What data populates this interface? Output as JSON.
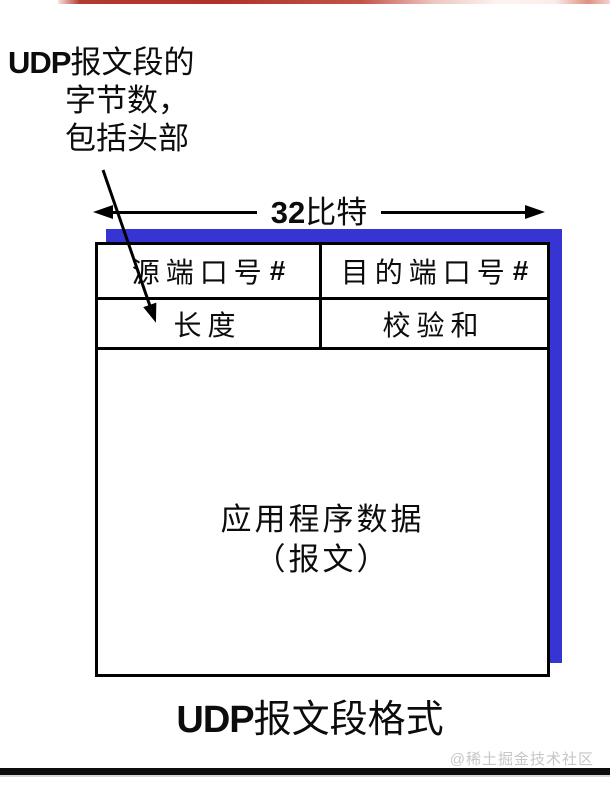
{
  "annotation": {
    "line1_latin": "UDP",
    "line1_cjk": "报文段的",
    "line2": "字节数，",
    "line3": "包括头部"
  },
  "width_label": {
    "number": "32",
    "unit": "比特"
  },
  "table": {
    "row1": {
      "cell1": {
        "label": "源端口号",
        "suffix": "#"
      },
      "cell2": {
        "label": "目的端口号",
        "suffix": "#"
      }
    },
    "row2": {
      "cell1": {
        "label": "长度",
        "suffix": ""
      },
      "cell2": {
        "label": "校验和",
        "suffix": ""
      }
    },
    "payload": {
      "line1": "应用程序数据",
      "line2": "（报文）"
    }
  },
  "caption": {
    "latin": "UDP",
    "cjk": "报文段格式"
  },
  "watermark": "@稀土掘金技术社区",
  "colors": {
    "shadow_blue": "#3634d2",
    "top_bar_red": "#b23a30",
    "bottom_bar_black": "#0d0d0d",
    "watermark_gray": "#c6c6c6"
  }
}
